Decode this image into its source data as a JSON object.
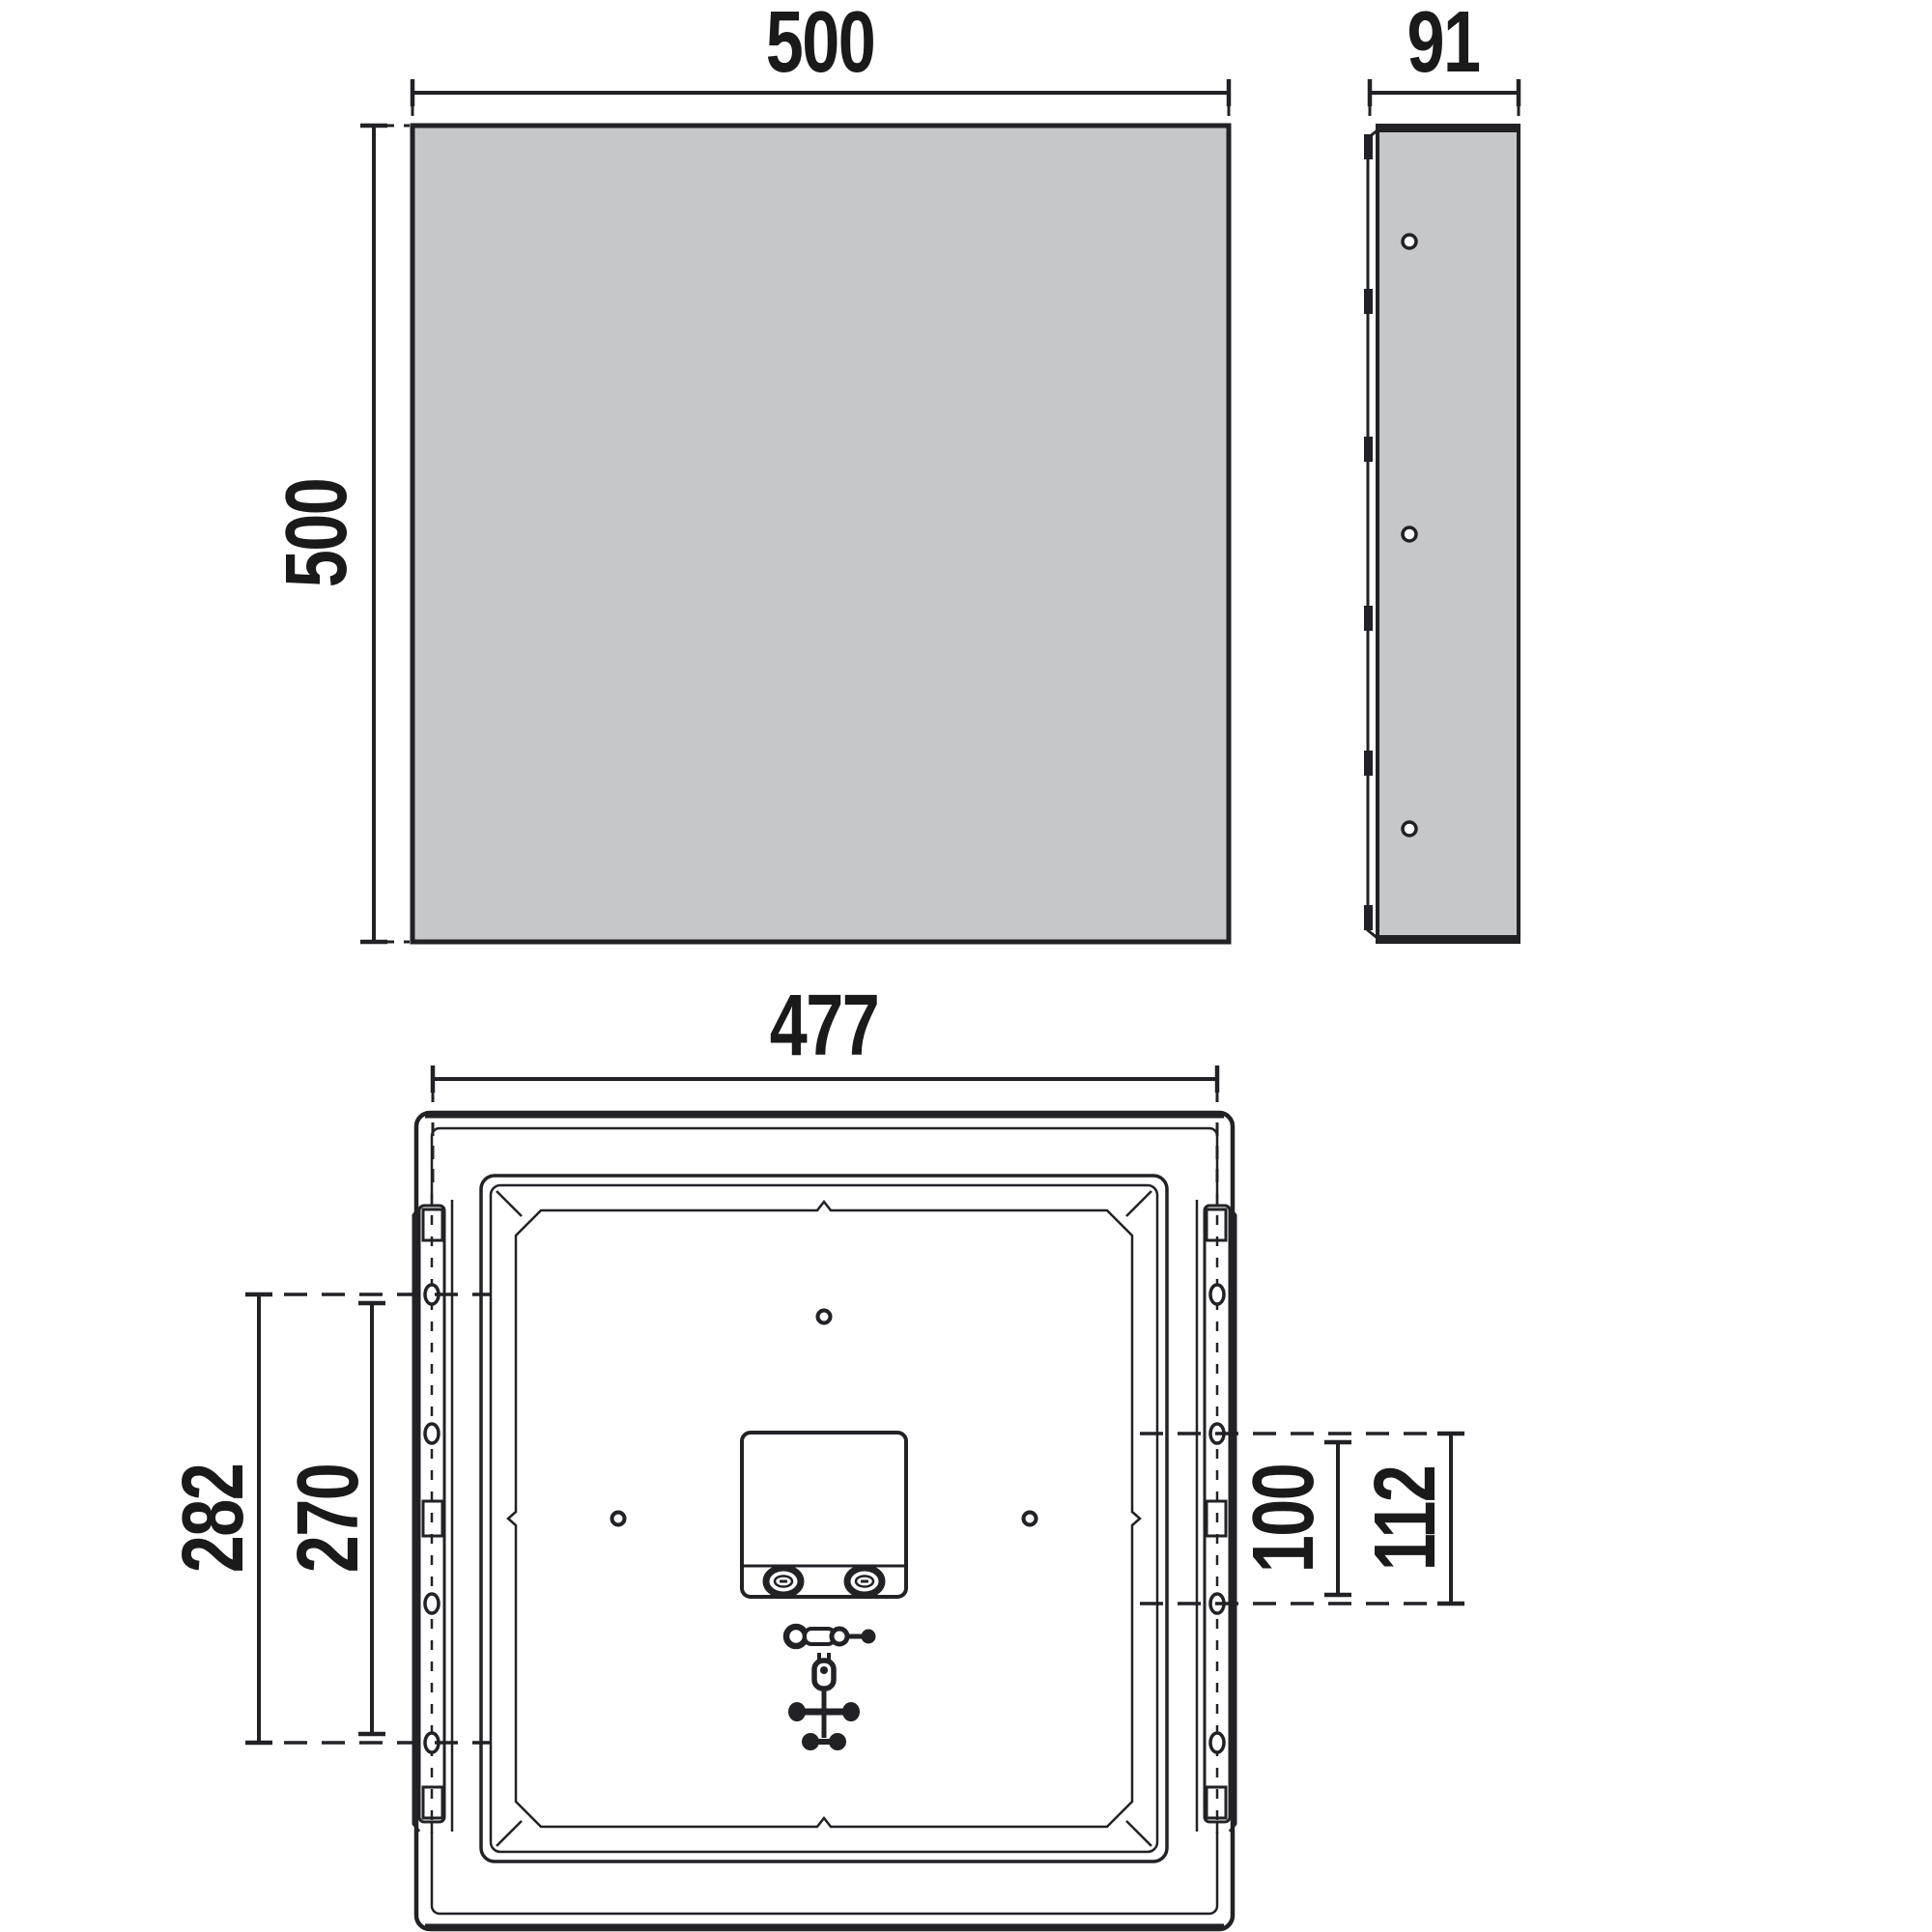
{
  "labels": {
    "front_width": "500",
    "front_height": "500",
    "side_width": "91",
    "rear_width": "477",
    "rear_left_outer": "282",
    "rear_left_inner": "270",
    "rear_right_inner": "100",
    "rear_right_outer": "112"
  },
  "colors": {
    "panel_fill": "#c6c7c9",
    "line_color": "#212126",
    "text_color": "#1a1a1a",
    "background": "#ffffff"
  }
}
